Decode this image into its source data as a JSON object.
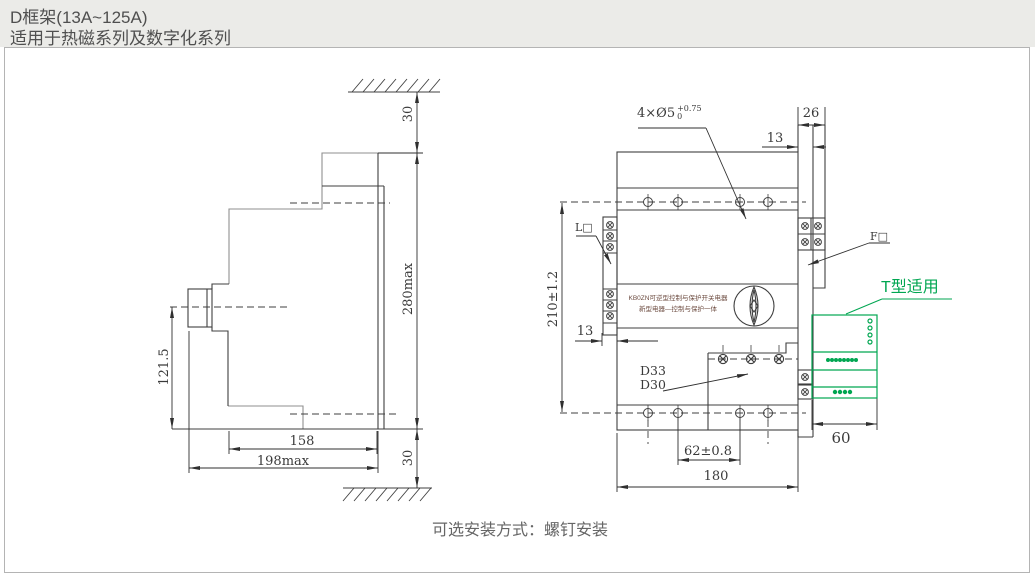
{
  "header": {
    "title": "D框架(13A~125A)",
    "subtitle": "适用于热磁系列及数字化系列"
  },
  "caption": "可选安装方式：螺钉安装",
  "side_view": {
    "dim_top_gap": "30",
    "dim_height": "280max",
    "dim_bottom_gap": "30",
    "dim_center_height": "121.5",
    "dim_depth": "158",
    "dim_depth_max": "198max"
  },
  "front_view": {
    "hole_callout": {
      "text": "4×Ø5",
      "tol_plus": "+0.75",
      "tol_minus": "0"
    },
    "dim_accessory_width": "26",
    "dim_accessory_offset": "13",
    "dim_height": "210±1.2",
    "dim_terminal_offset": "13",
    "dim_hole_spacing": "62±0.8",
    "dim_width": "180",
    "dim_module_width": "60",
    "label_left_terminal": "L□",
    "label_right_terminal": "F□",
    "label_d33": "D33",
    "label_d30": "D30",
    "module_label": "T型适用",
    "face_text_line1": "KB0ZN可逆型控制与保护开关电器",
    "face_text_line2": "新型电器—控制与保护一体"
  },
  "colors": {
    "accent_green": "#00a651",
    "line_dark": "#3f3f3f",
    "line_gray": "#8f8f8f",
    "face_text": "#6d4c41",
    "header_bg": "#ebebe8"
  }
}
